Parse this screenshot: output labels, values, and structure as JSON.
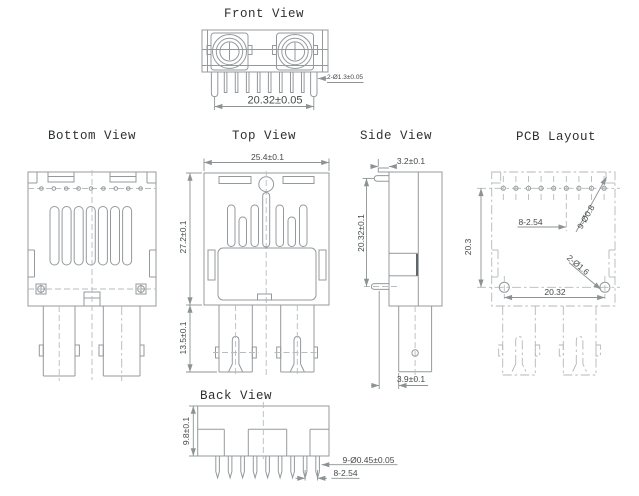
{
  "views": {
    "front": {
      "title": "Front View",
      "dims": {
        "pin_diameter": "2-Ø1.3±0.05",
        "pin_row_span": "20.32±0.05"
      }
    },
    "bottom": {
      "title": "Bottom View"
    },
    "top": {
      "title": "Top View",
      "dims": {
        "body_width": "25.4±0.1",
        "body_length": "27.2±0.1",
        "leg_length": "13.5±0.1"
      }
    },
    "side": {
      "title": "Side View",
      "dims": {
        "top_step": "3.2±0.1",
        "pin_row_offset": "20.32±0.1",
        "leg_offset": "3.9±0.1"
      }
    },
    "pcb": {
      "title": "PCB Layout",
      "dims": {
        "row_spacing": "20.3",
        "hole_pitch": "8-2.54",
        "signal_holes": "9-Ø0.8",
        "mount_holes": "2-Ø1.6",
        "mount_span": "20.32"
      }
    },
    "back": {
      "title": "Back View",
      "dims": {
        "body_height": "9.8±0.1",
        "pin_diameter": "9-Ø0.45±0.05",
        "pin_pitch": "8-2.54"
      }
    }
  },
  "colors": {
    "geometry_line": "#949a9c",
    "center_line": "#b7bcbd",
    "dimension_line": "#8d9394",
    "text": "#45494a",
    "title_text": "#2e3132",
    "background": "#ffffff"
  }
}
